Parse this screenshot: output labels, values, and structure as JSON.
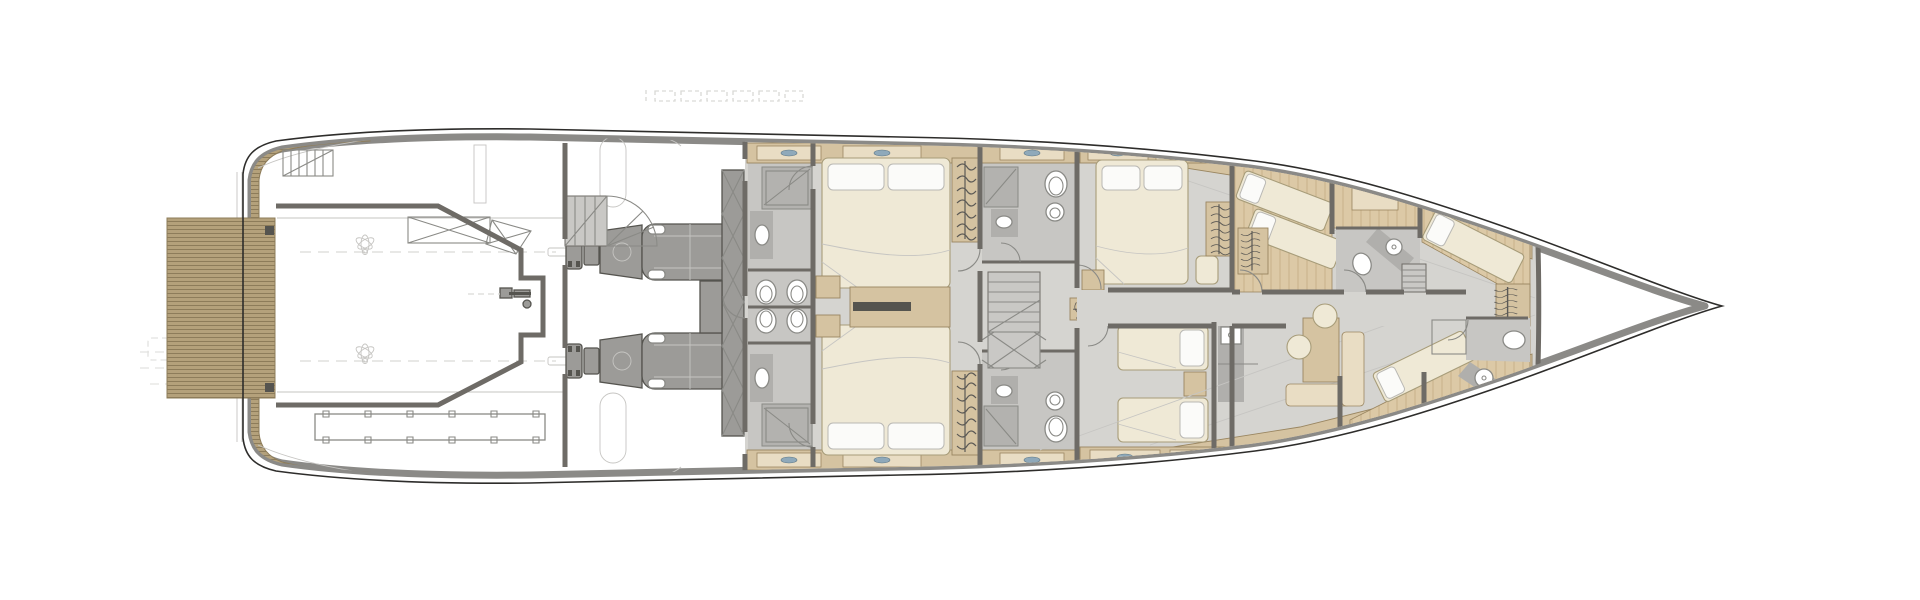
{
  "meta": {
    "description": "Top-down naval architecture floor plan of a motor yacht lower deck; line drawing with teak decks, engine room and cabins. No text labels are rendered in the image.",
    "visible_text": []
  },
  "palette": {
    "background": "#ffffff",
    "hull-line": "#2e2d2b",
    "bulwark": "#8b8a87",
    "wall": "#6e6b66",
    "teak": "#b4a17b",
    "teak-line": "#8d7c5a",
    "wood": "#d5c3a1",
    "wood-light": "#e9ddc4",
    "wood-dark": "#9a8661",
    "wood-floor": "#dcc9a6",
    "wood-line": "#c3ab82",
    "floor": "#d5d4d0",
    "floor-dark": "#c7c6c3",
    "fixture": "#ffffff",
    "fixture-line": "#8a8a86",
    "bed": "#efe9d6",
    "bed-line": "#a79c79",
    "pillow": "#fbfbf9",
    "engine": "#9c9b98",
    "engine-dark": "#55544f",
    "porthole": "#a3b8c4",
    "handle": "#8fa9ba",
    "stair": "#c9c8c5",
    "ghost": "#d9d9d6",
    "shadow": "#b0afac",
    "hang": "#5b5955"
  },
  "features": [
    "hull",
    "swim-platform",
    "transom-stairs",
    "boarding-ladder",
    "tender-garage",
    "garage-crane",
    "platform-machinery",
    "propeller-shafts",
    "spiral-staircase",
    "engine-room",
    "main-engines",
    "fuel-tank",
    "guest-bathroom-starboard",
    "guest-bathroom-port",
    "guest-cabin-starboard",
    "guest-cabin-port",
    "midship-lobby",
    "lobby-bathroom-starboard",
    "lobby-bathroom-port",
    "lobby-staircase",
    "vip-cabin",
    "twin-guest-cabin",
    "crew-corridor",
    "crew-stairs",
    "crew-cabin-aft",
    "crew-cabin-mid",
    "crew-bathroom",
    "crew-mess",
    "bow-crew-cabin",
    "bow-bathroom",
    "teak-side-decks",
    "portholes",
    "ghost-outlines"
  ],
  "counts": {
    "main_engines": 2,
    "double_beds": 3,
    "single_beds": 2,
    "crew_berths": 5,
    "portholes_visible": 10
  }
}
